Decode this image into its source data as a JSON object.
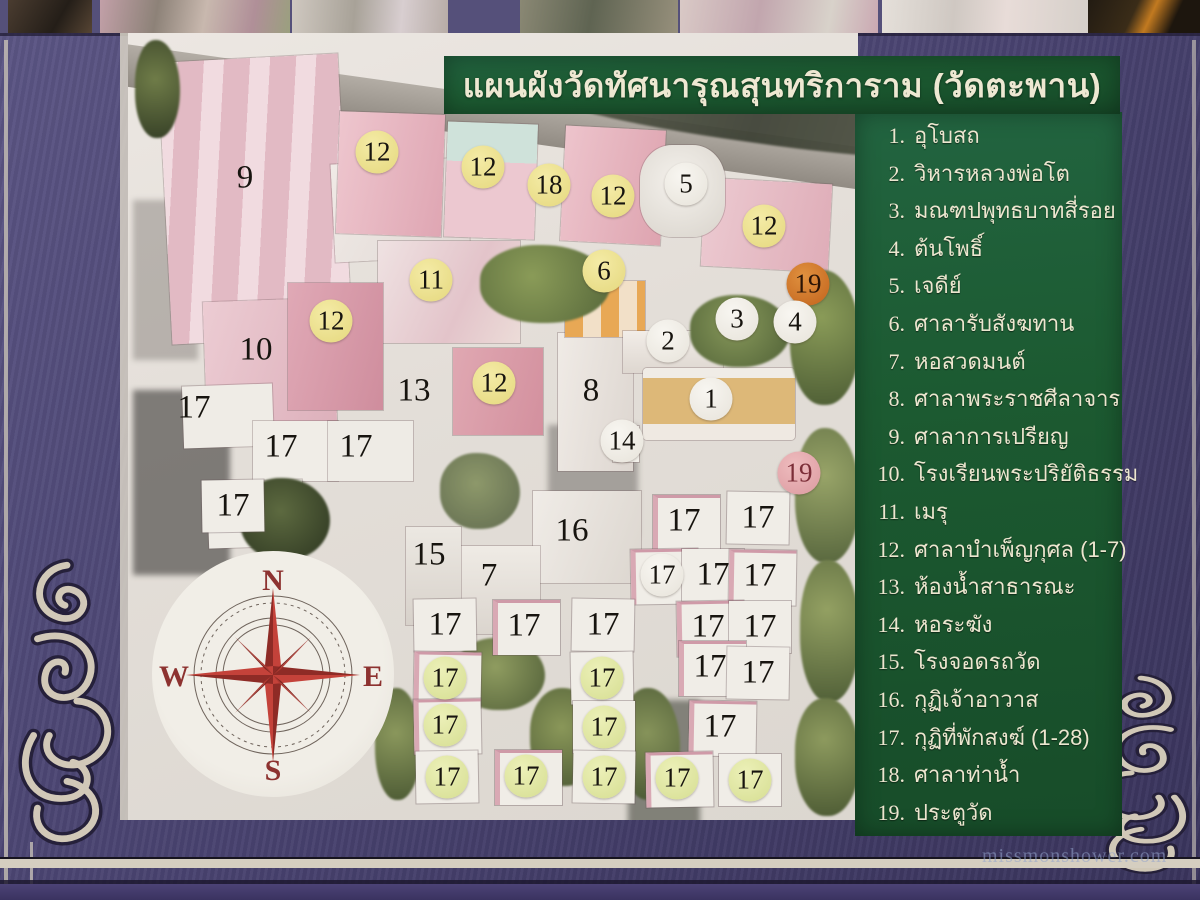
{
  "sign": {
    "title": "แผนผังวัดทัศนารุณสุนทริการาม (วัดตะพาน)",
    "legend": [
      {
        "num": "1.",
        "label": "อุโบสถ"
      },
      {
        "num": "2.",
        "label": "วิหารหลวงพ่อโต"
      },
      {
        "num": "3.",
        "label": "มณฑปพุทธบาทสี่รอย"
      },
      {
        "num": "4.",
        "label": "ต้นโพธิ์"
      },
      {
        "num": "5.",
        "label": "เจดีย์"
      },
      {
        "num": "6.",
        "label": "ศาลารับสังฆทาน"
      },
      {
        "num": "7.",
        "label": "หอสวดมนต์"
      },
      {
        "num": "8.",
        "label": "ศาลาพระราชศีลาจาร"
      },
      {
        "num": "9.",
        "label": "ศาลาการเปรียญ"
      },
      {
        "num": "10.",
        "label": "โรงเรียนพระปริยัติธรรม"
      },
      {
        "num": "11.",
        "label": "เมรุ"
      },
      {
        "num": "12.",
        "label": "ศาลาบำเพ็ญกุศล (1-7)"
      },
      {
        "num": "13.",
        "label": "ห้องน้ำสาธารณะ"
      },
      {
        "num": "14.",
        "label": "หอระฆัง"
      },
      {
        "num": "15.",
        "label": "โรงจอดรถวัด"
      },
      {
        "num": "16.",
        "label": "กุฏิเจ้าอาวาส"
      },
      {
        "num": "17.",
        "label": "กุฏิที่พักสงฆ์ (1-28)"
      },
      {
        "num": "18.",
        "label": "ศาลาท่าน้ำ"
      },
      {
        "num": "19.",
        "label": "ประตูวัด"
      }
    ]
  },
  "compass": {
    "n": "N",
    "e": "E",
    "s": "S",
    "w": "W"
  },
  "markers": [
    {
      "n": "9",
      "x": 245,
      "y": 178,
      "t": "plain"
    },
    {
      "n": "12",
      "x": 377,
      "y": 152,
      "t": "yellow"
    },
    {
      "n": "12",
      "x": 483,
      "y": 167,
      "t": "yellow"
    },
    {
      "n": "18",
      "x": 549,
      "y": 185,
      "t": "yellow"
    },
    {
      "n": "12",
      "x": 613,
      "y": 196,
      "t": "yellow"
    },
    {
      "n": "5",
      "x": 686,
      "y": 184,
      "t": "white"
    },
    {
      "n": "12",
      "x": 764,
      "y": 226,
      "t": "yellow"
    },
    {
      "n": "11",
      "x": 431,
      "y": 280,
      "t": "yellow"
    },
    {
      "n": "6",
      "x": 604,
      "y": 271,
      "t": "yellow"
    },
    {
      "n": "19",
      "x": 808,
      "y": 284,
      "t": "orange"
    },
    {
      "n": "12",
      "x": 331,
      "y": 321,
      "t": "yellow"
    },
    {
      "n": "3",
      "x": 737,
      "y": 319,
      "t": "white"
    },
    {
      "n": "4",
      "x": 795,
      "y": 322,
      "t": "white"
    },
    {
      "n": "2",
      "x": 668,
      "y": 341,
      "t": "white"
    },
    {
      "n": "10",
      "x": 256,
      "y": 350,
      "t": "plain"
    },
    {
      "n": "13",
      "x": 414,
      "y": 391,
      "t": "plain"
    },
    {
      "n": "12",
      "x": 494,
      "y": 383,
      "t": "yellow"
    },
    {
      "n": "8",
      "x": 591,
      "y": 391,
      "t": "plain"
    },
    {
      "n": "1",
      "x": 711,
      "y": 399,
      "t": "white"
    },
    {
      "n": "17",
      "x": 194,
      "y": 408,
      "t": "plain"
    },
    {
      "n": "14",
      "x": 622,
      "y": 441,
      "t": "white"
    },
    {
      "n": "17",
      "x": 281,
      "y": 447,
      "t": "plain"
    },
    {
      "n": "17",
      "x": 356,
      "y": 447,
      "t": "plain"
    },
    {
      "n": "19",
      "x": 799,
      "y": 473,
      "t": "pink"
    },
    {
      "n": "17",
      "x": 233,
      "y": 506,
      "t": "plain"
    },
    {
      "n": "16",
      "x": 572,
      "y": 531,
      "t": "plain"
    },
    {
      "n": "17",
      "x": 684,
      "y": 521,
      "t": "plain"
    },
    {
      "n": "17",
      "x": 758,
      "y": 518,
      "t": "plain"
    },
    {
      "n": "15",
      "x": 429,
      "y": 555,
      "t": "plain"
    },
    {
      "n": "7",
      "x": 489,
      "y": 576,
      "t": "plain"
    },
    {
      "n": "17",
      "x": 662,
      "y": 575,
      "t": "white"
    },
    {
      "n": "17",
      "x": 713,
      "y": 575,
      "t": "plain"
    },
    {
      "n": "17",
      "x": 760,
      "y": 576,
      "t": "plain"
    },
    {
      "n": "17",
      "x": 445,
      "y": 625,
      "t": "plain"
    },
    {
      "n": "17",
      "x": 524,
      "y": 626,
      "t": "plain"
    },
    {
      "n": "17",
      "x": 603,
      "y": 625,
      "t": "plain"
    },
    {
      "n": "17",
      "x": 708,
      "y": 627,
      "t": "plain"
    },
    {
      "n": "17",
      "x": 760,
      "y": 627,
      "t": "plain"
    },
    {
      "n": "17",
      "x": 445,
      "y": 678,
      "t": "green"
    },
    {
      "n": "17",
      "x": 602,
      "y": 678,
      "t": "green"
    },
    {
      "n": "17",
      "x": 710,
      "y": 667,
      "t": "plain"
    },
    {
      "n": "17",
      "x": 758,
      "y": 673,
      "t": "plain"
    },
    {
      "n": "17",
      "x": 445,
      "y": 725,
      "t": "green"
    },
    {
      "n": "17",
      "x": 604,
      "y": 727,
      "t": "green"
    },
    {
      "n": "17",
      "x": 720,
      "y": 727,
      "t": "plain"
    },
    {
      "n": "17",
      "x": 447,
      "y": 777,
      "t": "green"
    },
    {
      "n": "17",
      "x": 526,
      "y": 776,
      "t": "green"
    },
    {
      "n": "17",
      "x": 604,
      "y": 777,
      "t": "green"
    },
    {
      "n": "17",
      "x": 677,
      "y": 778,
      "t": "green"
    },
    {
      "n": "17",
      "x": 750,
      "y": 780,
      "t": "green"
    }
  ],
  "watermark": "missmonshower.com",
  "colors": {
    "panel_green": "#1c5930",
    "frame_purple": "#4a4370",
    "marker_yellow": "#eadc84",
    "marker_white": "#f2efe8",
    "marker_orange": "#c96a28",
    "marker_pink": "#e2a4aa",
    "marker_green": "#dde29a",
    "compass_red": "#b03a32",
    "text_cream": "#ece6cf"
  }
}
